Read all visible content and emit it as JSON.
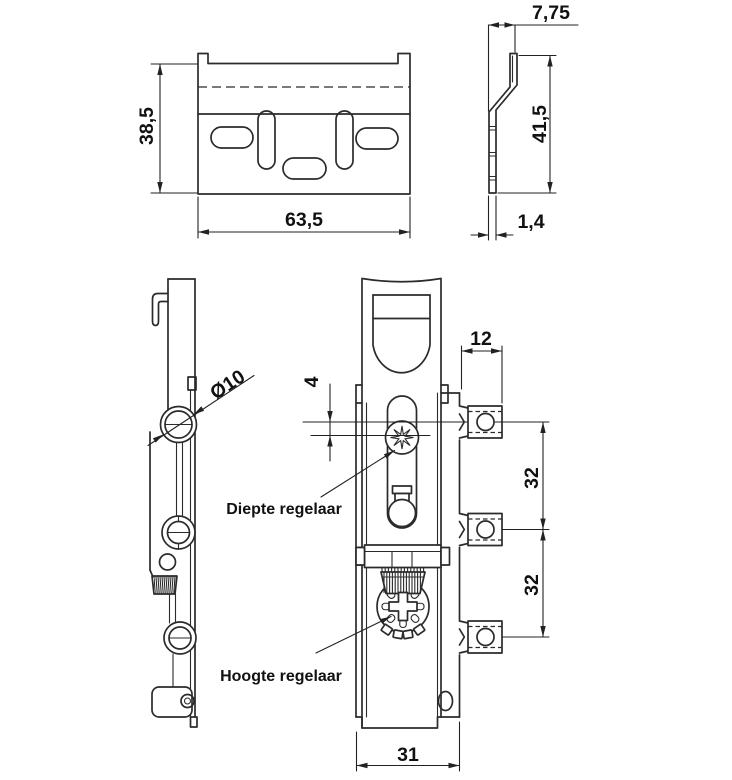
{
  "drawing": {
    "background_color": "#ffffff",
    "line_color": "#2b2b2b",
    "text_color": "#111111",
    "plate_front_view": {
      "height_dim": "38,5",
      "width_dim": "63,5"
    },
    "plate_side_view": {
      "flange_offset_dim": "7,75",
      "height_dim": "41,5",
      "thickness_dim": "1,4"
    },
    "arm_side_view": {
      "hole_diameter_dim": "Ø10"
    },
    "arm_front_view": {
      "depth_travel_dim": "4",
      "body_width_dim": "31",
      "depth_adjuster_label": "Diepte regelaar",
      "height_adjuster_label": "Hoogte regelaar"
    },
    "mounting_tabs": {
      "tab_width_dim": "12",
      "tab_spacing_upper_dim": "32",
      "tab_spacing_lower_dim": "32"
    }
  }
}
